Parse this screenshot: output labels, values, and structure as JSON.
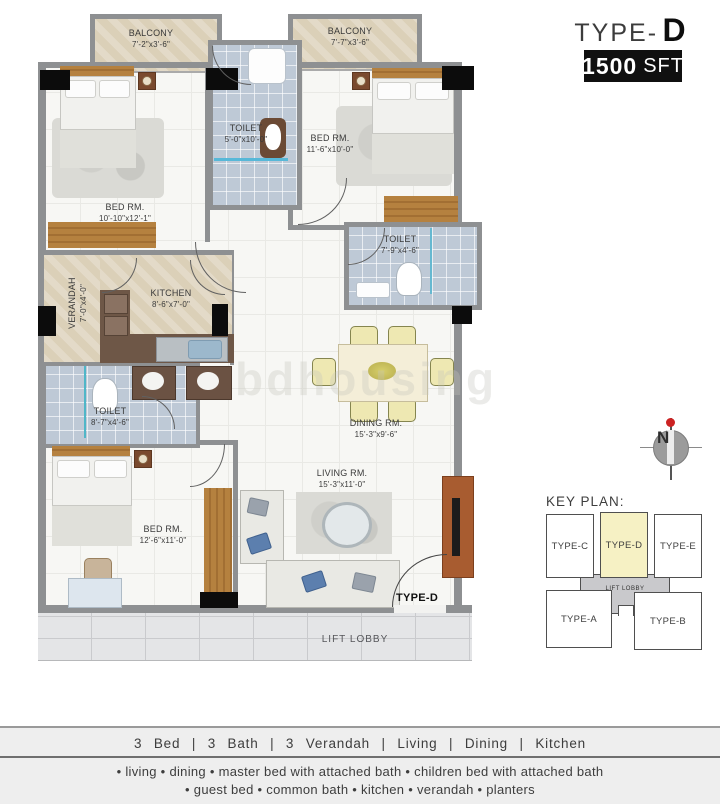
{
  "header": {
    "type_prefix": "TYPE-",
    "type_letter": "D",
    "area_number": "1500",
    "area_unit": "SFT"
  },
  "watermark": "bdhousing",
  "compass": {
    "label": "N"
  },
  "plan": {
    "balcony_left": {
      "name": "BALCONY",
      "dims": "7'-2\"x3'-6\""
    },
    "balcony_right": {
      "name": "BALCONY",
      "dims": "7'-7\"x3'-6\""
    },
    "bed_top_left": {
      "name": "BED RM.",
      "dims": "10'-10\"x12'-1\""
    },
    "toilet_top": {
      "name": "TOILET",
      "dims": "5'-0\"x10'-0\""
    },
    "bed_top_right": {
      "name": "BED RM.",
      "dims": "11'-6\"x10'-0\""
    },
    "toilet_right": {
      "name": "TOILET",
      "dims": "7'-9\"x4'-6\""
    },
    "verandah": {
      "name": "VERANDAH",
      "dims": "7'-0\"x4'-0\""
    },
    "kitchen": {
      "name": "KITCHEN",
      "dims": "8'-6\"x7'-0\""
    },
    "toilet_left": {
      "name": "TOILET",
      "dims": "8'-7\"x4'-6\""
    },
    "dining": {
      "name": "DINING RM.",
      "dims": "15'-3\"x9'-6\""
    },
    "living": {
      "name": "LIVING RM.",
      "dims": "15'-3\"x11'-0\""
    },
    "bed_bottom": {
      "name": "BED RM.",
      "dims": "12'-6\"x11'-0\""
    },
    "entrance_label": "TYPE-D",
    "lift_lobby": "LIFT LOBBY"
  },
  "key_plan": {
    "heading": "KEY PLAN:",
    "type_c": "TYPE-C",
    "type_d": "TYPE-D",
    "type_e": "TYPE-E",
    "type_a": "TYPE-A",
    "type_b": "TYPE-B",
    "lift_lobby": "LIFT LOBBY",
    "highlighted_unit": "TYPE-D"
  },
  "footer": {
    "summary": "3 Bed  |  3 Bath  |  3 Verandah  |  Living  |  Dining  |  Kitchen",
    "features_line1": "• living   • dining  • master bed with attached bath   • children bed with attached bath",
    "features_line2": "• guest bed  • common bath  •  kitchen  •  verandah   • planters"
  },
  "colors": {
    "badge_bg": "#101010",
    "keyplan_highlight": "#f6f1c4",
    "tile_blue": "#bec9d6",
    "marble_beige": "#dbd0b8",
    "wall_gray": "#8e9092",
    "compass_red": "#cc2323"
  }
}
